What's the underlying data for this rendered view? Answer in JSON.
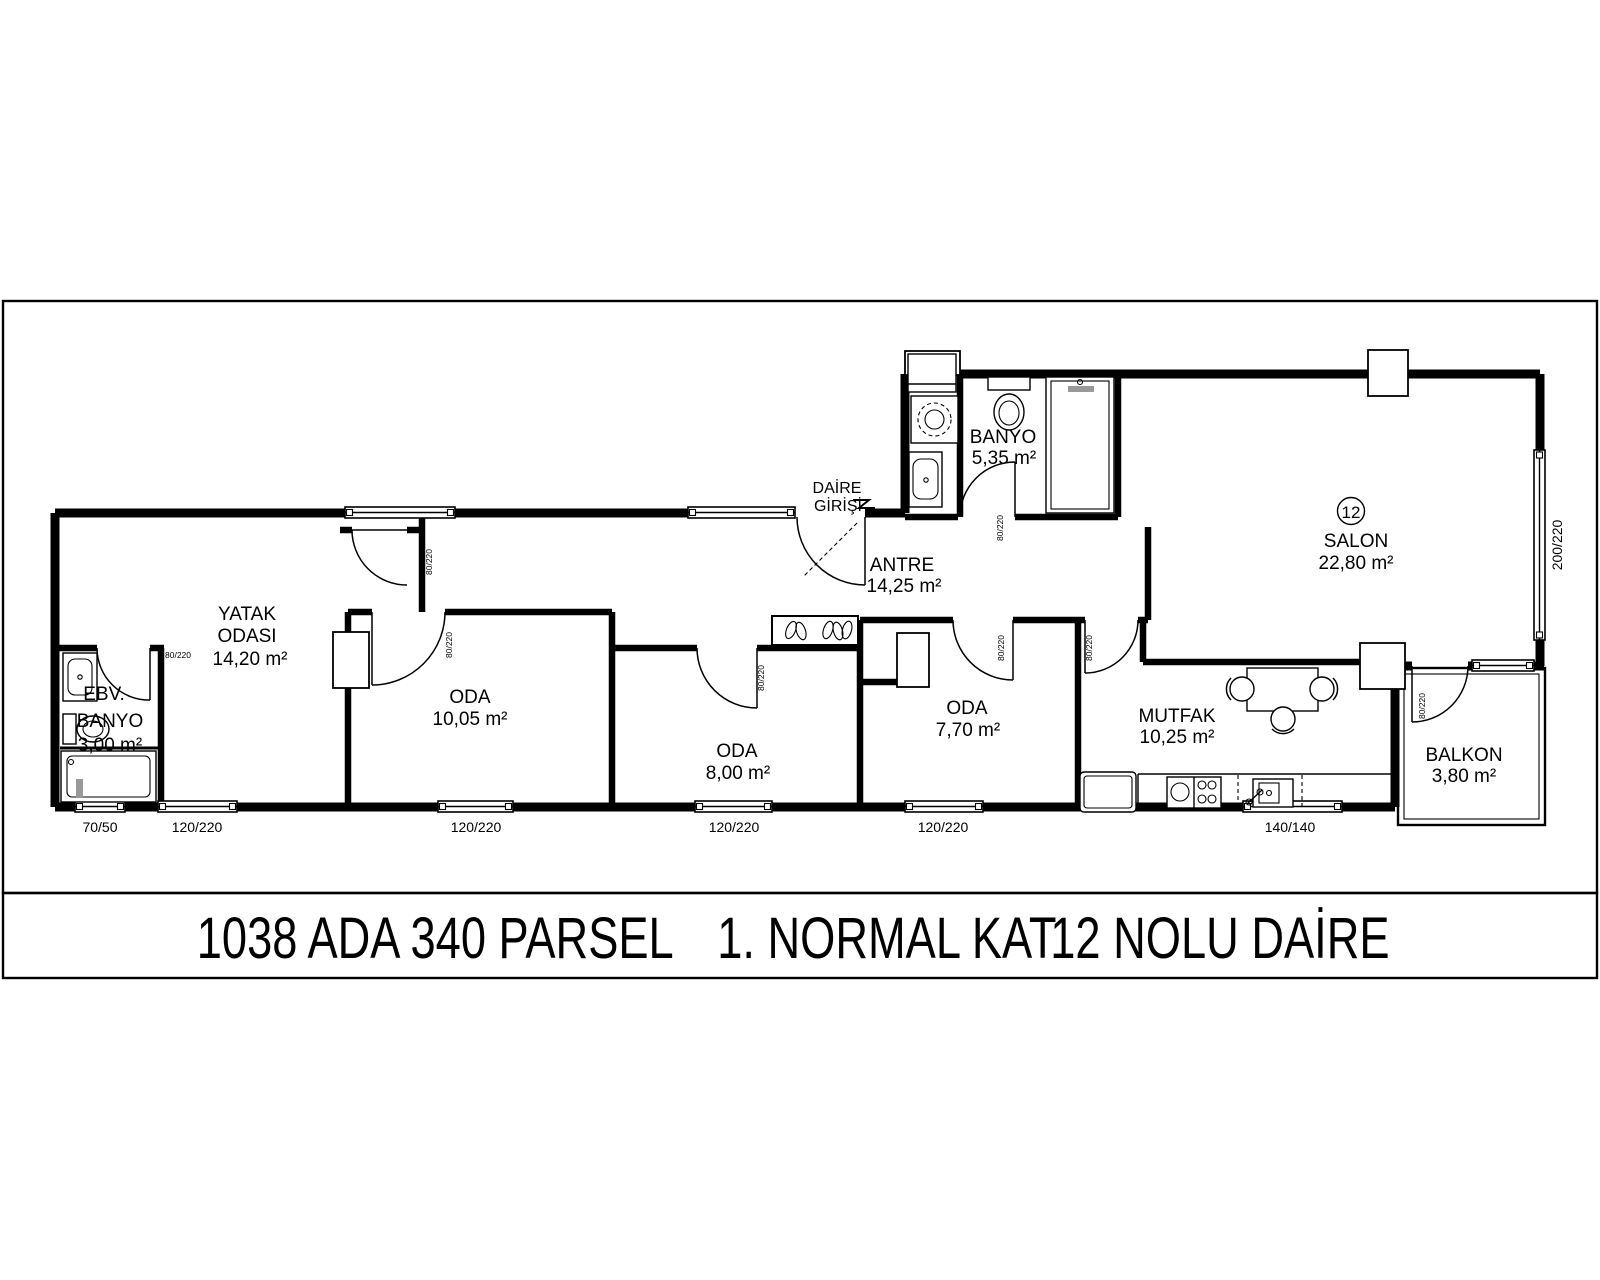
{
  "title": {
    "part1": "1038 ADA 340 PARSEL",
    "part2": "1. NORMAL KAT",
    "part3": "12 NOLU DAİRE"
  },
  "entrance": {
    "line1": "DAİRE",
    "line2": "GİRİŞİ"
  },
  "rooms": {
    "yatak": {
      "line1": "YATAK",
      "line2": "ODASI",
      "area": "14,20 m²"
    },
    "ebv": {
      "line1": "EBV.",
      "line2": "BANYO",
      "area": "3,00 m²"
    },
    "oda1": {
      "name": "ODA",
      "area": "10,05 m²"
    },
    "oda2": {
      "name": "ODA",
      "area": "8,00 m²"
    },
    "oda3": {
      "name": "ODA",
      "area": "7,70 m²"
    },
    "antre": {
      "name": "ANTRE",
      "area": "14,25 m²"
    },
    "banyo": {
      "name": "BANYO",
      "area": "5,35 m²"
    },
    "salon": {
      "name": "SALON",
      "area": "22,80 m²",
      "unit_no": "12"
    },
    "mutfak": {
      "name": "MUTFAK",
      "area": "10,25 m²"
    },
    "balkon": {
      "name": "BALKON",
      "area": "3,80 m²"
    }
  },
  "dims": {
    "win_ebv": "70/50",
    "win_yatak": "120/220",
    "win_oda1": "120/220",
    "win_oda2": "120/220",
    "win_oda3": "120/220",
    "win_mutfak": "140/140",
    "win_salon": "200/220",
    "door_tag": "80/220"
  },
  "colors": {
    "line": "#000000",
    "paper": "#ffffff",
    "fixture_gray": "#999999"
  }
}
